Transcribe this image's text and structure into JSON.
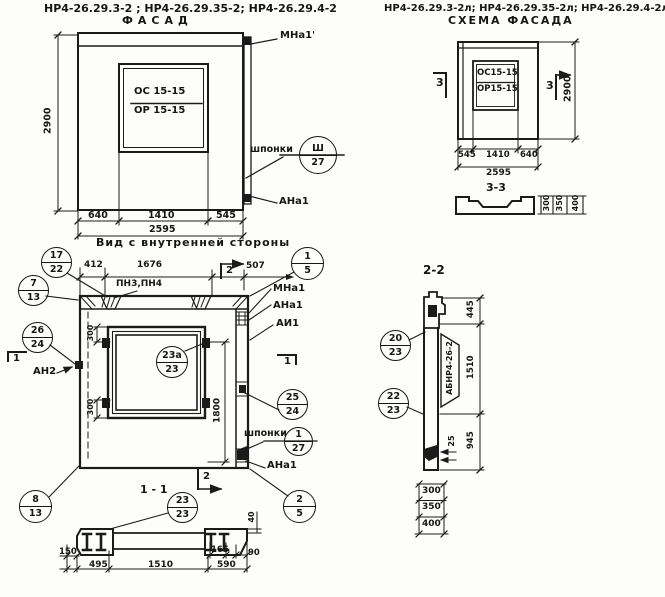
{
  "header": {
    "codes_left": "НР4-26.29.3-2 ; НР4-26.29.35-2; НР4-26.29.4-2",
    "codes_right": "НР4-26.29.3-2л; НР4-26.29.35-2л; НР4-26.29.4-2л"
  },
  "facade": {
    "title": "ФАСАД",
    "window_top": "ОС 15-15",
    "window_bottom": "ОР 15-15",
    "height": "2900",
    "d640": "640",
    "d1410": "1410",
    "d545": "545",
    "total": "2595",
    "mna1": "МНа1'",
    "shponki": "шпонки",
    "ana1": "АНа1"
  },
  "schema": {
    "title": "СХЕМА ФАСАДА",
    "window_top": "ОС15-15",
    "window_bottom": "ОР15-15",
    "height": "2900",
    "d545": "545",
    "d1410": "1410",
    "d640": "640",
    "total": "2595",
    "mark3": "3",
    "section_label": "3-3",
    "d300": "300",
    "d350": "350",
    "d400": "400"
  },
  "inner": {
    "title": "Вид с внутренней стороны",
    "d412": "412",
    "d1676": "1676",
    "d507": "507",
    "pn": "ПН3,ПН4",
    "mark2": "2",
    "mark1": "1",
    "mna1": "МНа1",
    "ana1": "АНа1",
    "ai1": "АИ1",
    "an2": "АН2",
    "d300": "300",
    "d1800": "1800",
    "shponki": "шпонки",
    "ana1_b": "АНа1"
  },
  "s11": {
    "label": "1 - 1",
    "d40": "40",
    "d150": "150",
    "d165": "165",
    "d90": "90",
    "d495": "495",
    "d1510": "1510",
    "d590": "590"
  },
  "s22": {
    "label": "2-2",
    "abnr": "АБНР4-26-2",
    "d445": "445",
    "d1510": "1510",
    "d945": "945",
    "d25": "25",
    "d300": "300",
    "d350": "350",
    "d400": "400"
  },
  "callouts": {
    "sh27": {
      "top": "Ш",
      "bottom": "27"
    },
    "c17_22": {
      "top": "17",
      "bottom": "22"
    },
    "c7_13": {
      "top": "7",
      "bottom": "13"
    },
    "c26_24": {
      "top": "26",
      "bottom": "24"
    },
    "c1_5": {
      "top": "1",
      "bottom": "5"
    },
    "c23a_23": {
      "top": "23а",
      "bottom": "23"
    },
    "c25_24": {
      "top": "25",
      "bottom": "24"
    },
    "c1_27": {
      "top": "1",
      "bottom": "27"
    },
    "c2_5": {
      "top": "2",
      "bottom": "5"
    },
    "c8_13": {
      "top": "8",
      "bottom": "13"
    },
    "c23_23": {
      "top": "23",
      "bottom": "23"
    },
    "c20_23": {
      "top": "20",
      "bottom": "23"
    },
    "c22_23": {
      "top": "22",
      "bottom": "23"
    }
  },
  "colors": {
    "ink": "#1b1b1b",
    "paper": "#fdfdfb"
  }
}
